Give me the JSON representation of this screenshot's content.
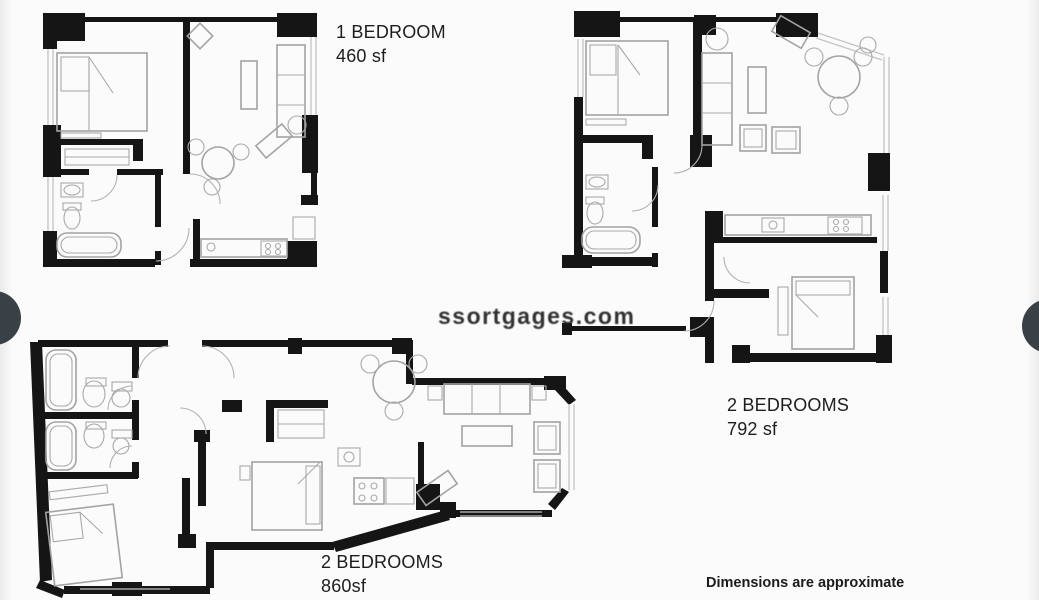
{
  "gallery": {
    "prev_button": {
      "icon": "chevron-left-icon",
      "glyph": "❮"
    },
    "next_button": {
      "icon": "chevron-right-icon",
      "glyph": "❯"
    },
    "nav_button_color": "#394046",
    "background": "#fbfbfb"
  },
  "plans": [
    {
      "name": "1 BEDROOM",
      "area": "460 sf"
    },
    {
      "name": "2 BEDROOMS",
      "area": "792 sf"
    },
    {
      "name": "2 BEDROOMS",
      "area": "860sf"
    }
  ],
  "disclaimer": "Dimensions are approximate",
  "watermark": "ssortgages.com",
  "colors": {
    "wall": "#151515",
    "furniture": "#a3a3a3",
    "window": "#c4c4c4"
  }
}
